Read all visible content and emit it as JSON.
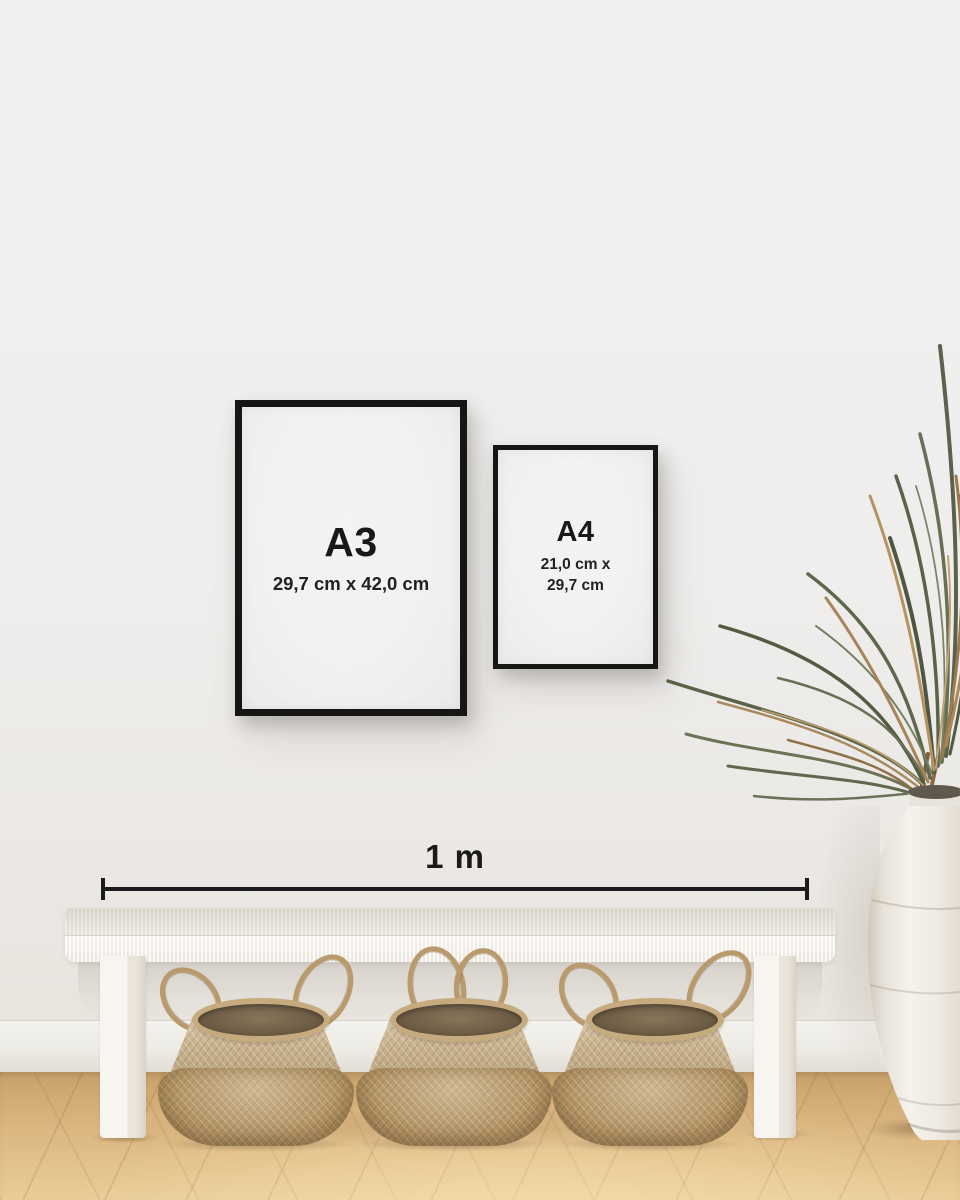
{
  "frames": {
    "a3": {
      "label": "A3",
      "dimensions": "29,7 cm x 42,0 cm"
    },
    "a4": {
      "label": "A4",
      "dimensions_line1": "21,0 cm x",
      "dimensions_line2": "29,7 cm"
    }
  },
  "scale_bar": {
    "label": "1 m"
  },
  "colors": {
    "wall": "#efefee",
    "baseboard": "#efece7",
    "floor": "#dcb77f",
    "floor_dark": "#c79f69",
    "frame_border": "#161615",
    "paper": "#f2f1ef",
    "ink": "#1d1d1d",
    "bench": "#f6f3ee",
    "bench_shade": "#ddd6cb",
    "basket_light": "#cbb490",
    "basket_dark": "#b39464",
    "basket_rim": "#c6ab7e",
    "basket_interior": "#6e5d45",
    "rope": "#b89a6c",
    "plant_green": "#5d654b",
    "plant_green_dark": "#4e5640",
    "plant_brown": "#a9855a",
    "vase": "#f2eee7",
    "vase_shade": "#d3ccbf"
  }
}
